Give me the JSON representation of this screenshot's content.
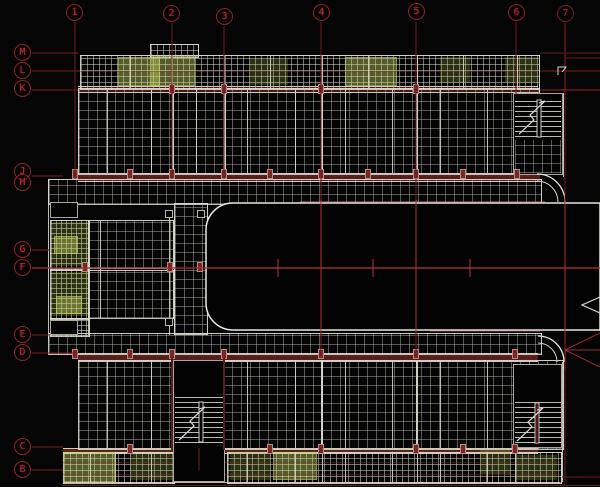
{
  "meta": {
    "type": "cad-structural-floor-plan",
    "description": "AutoCAD style building floor plan, U-shaped block with courtyard, on black model-space background"
  },
  "axes": {
    "top": [
      {
        "label": "1"
      },
      {
        "label": "2"
      },
      {
        "label": "3"
      },
      {
        "label": "4"
      },
      {
        "label": "5"
      },
      {
        "label": "6"
      },
      {
        "label": "7"
      }
    ],
    "left": [
      {
        "label": "M"
      },
      {
        "label": "L"
      },
      {
        "label": "K"
      },
      {
        "label": "J"
      },
      {
        "label": "H"
      },
      {
        "label": "G"
      },
      {
        "label": "F"
      },
      {
        "label": "E"
      },
      {
        "label": "D"
      },
      {
        "label": "C"
      },
      {
        "label": "B"
      }
    ]
  },
  "colors": {
    "background": "#050505",
    "grid_hatch": "#c8c8be",
    "wall_line": "#e8e8e0",
    "wall_band": "#571c1c",
    "axis_line_dark": "#6e1a1a",
    "axis_line_bright": "#b73434",
    "bubble_stroke": "#8e2424",
    "bubble_text": "#b23030",
    "green_hatch": "#9aa84a",
    "pink_edge": "#c08080"
  }
}
